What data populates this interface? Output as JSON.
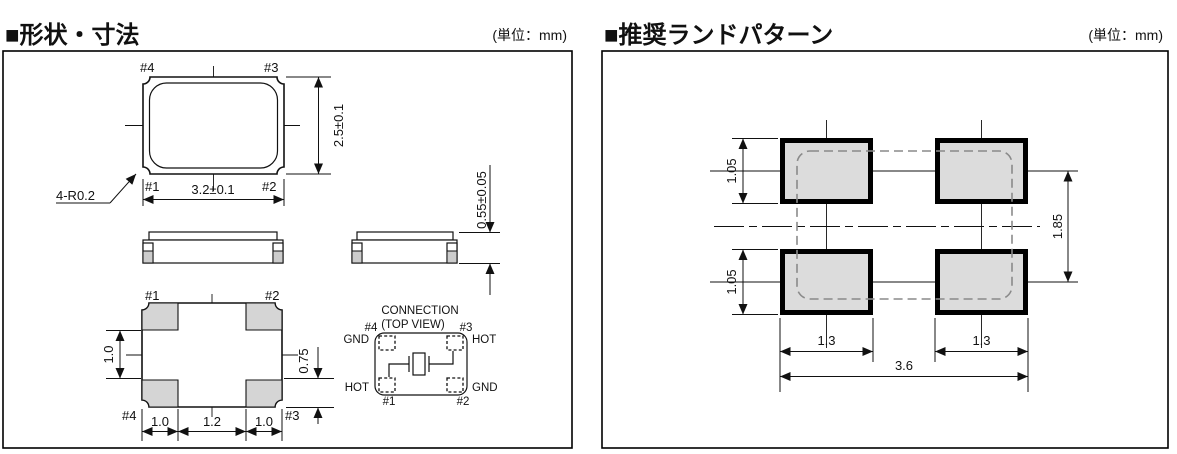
{
  "left": {
    "title": "■形状・寸法",
    "unit": "(単位：mm)",
    "top_view": {
      "pin_tl": "#4",
      "pin_tr": "#3",
      "pin_bl": "#1",
      "pin_br": "#2",
      "width_dim": "3.2±0.1",
      "height_dim": "2.5±0.1",
      "corner_radius_callout": "4-R0.2"
    },
    "side_view": {
      "thickness_dim": "0.55±0.05"
    },
    "bottom_view": {
      "pin_tl": "#1",
      "pin_tr": "#2",
      "pin_bl": "#4",
      "pin_br": "#3",
      "pad_dim_left": "1.0",
      "pad_dim_right": "0.75",
      "bottom_dims": [
        "1.0",
        "1.2",
        "1.0"
      ]
    },
    "connection": {
      "line1": "CONNECTION",
      "line2": "(TOP VIEW)",
      "pin_tl": "#4",
      "pin_tr": "#3",
      "pin_bl": "#1",
      "pin_br": "#2",
      "sig_tl": "GND",
      "sig_tr": "HOT",
      "sig_bl": "HOT",
      "sig_br": "GND"
    }
  },
  "right": {
    "title": "■推奨ランドパターン",
    "unit": "(単位：mm)",
    "land": {
      "pad_h_top": "1.05",
      "pad_h_bottom": "1.05",
      "pitch_v": "1.85",
      "pad_w_left": "1.3",
      "pad_w_right": "1.3",
      "total_w": "3.6"
    }
  },
  "colors": {
    "line": "#111111",
    "pad_gray": "#d5d5d5",
    "land_pad_gray": "#dcdcdc",
    "dashed_outline": "#8a8a8a",
    "background": "#ffffff"
  }
}
